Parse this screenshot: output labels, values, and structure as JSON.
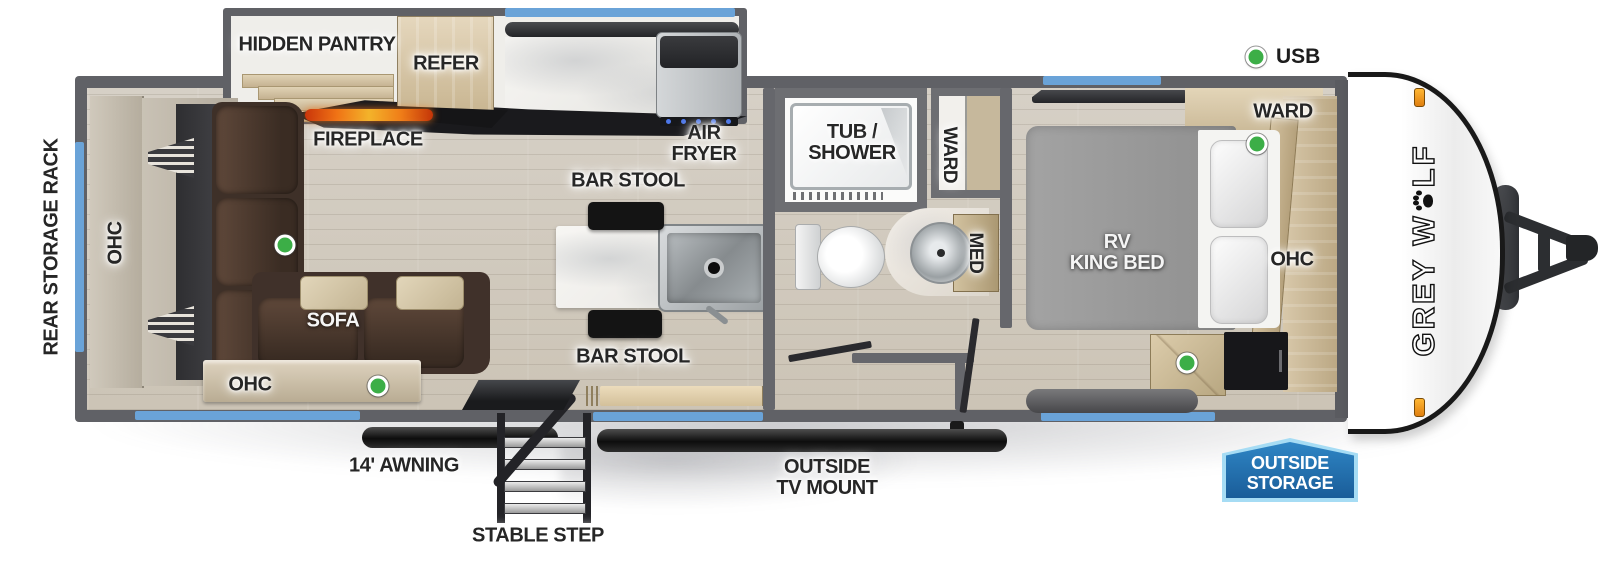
{
  "legend": {
    "usb": "USB"
  },
  "brand": {
    "part1": "GREY W",
    "part2": "LF"
  },
  "exterior": {
    "rear_storage_rack": "REAR STORAGE RACK",
    "awning": "14' AWNING",
    "stable_step": "STABLE STEP",
    "tv_mount_line1": "OUTSIDE",
    "tv_mount_line2": "TV MOUNT",
    "storage_badge_line1": "OUTSIDE",
    "storage_badge_line2": "STORAGE"
  },
  "living": {
    "hidden_pantry": "HIDDEN PANTRY",
    "fireplace": "FIREPLACE",
    "ohc_left": "OHC",
    "ohc_bottom": "OHC",
    "sofa": "SOFA"
  },
  "kitchen": {
    "refer": "REFER",
    "air_fryer_line1": "AIR",
    "air_fryer_line2": "FRYER",
    "bar_stool_top": "BAR STOOL",
    "bar_stool_bottom": "BAR STOOL"
  },
  "bathroom": {
    "tub_shower_line1": "TUB /",
    "tub_shower_line2": "SHOWER",
    "ward": "WARD",
    "med": "MED"
  },
  "bedroom": {
    "bed_line1": "RV",
    "bed_line2": "KING BED",
    "ward": "WARD",
    "ohc": "OHC"
  },
  "colors": {
    "window_blue": "#6aa3d8",
    "badge_blue": "#1f6ea8",
    "badge_border": "#a6dcf4",
    "usb_green": "#3cae47",
    "flame_orange": "#f07315",
    "marker_amber": "#f59b1e"
  }
}
